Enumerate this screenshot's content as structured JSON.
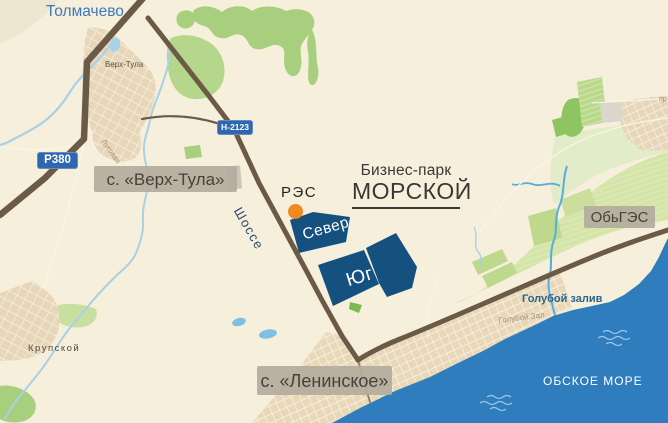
{
  "map": {
    "cities": {
      "tolmachevo": "Толмачево",
      "verh_tula_small": "Верх-Тула",
      "krupskoy": "Крупской"
    },
    "area_labels": {
      "verh_tula_village": "с. «Верх-Тула»",
      "leninskoe_village": "с. «Ленинское»",
      "obges": "ОбьГЭС"
    },
    "roads": {
      "r380_badge": "Р380",
      "n2123_badge": "Н-2123",
      "shosse": "Шоссе",
      "lugovaya_street": "Луговая",
      "prospekt_partial": "пр",
      "goluboy_zaliv_street": "Голубой Зал"
    },
    "business_park": {
      "name_line1": "Бизнес-парк",
      "name_line2": "МОРСКОЙ",
      "section_north": "Север",
      "section_south": "Юг",
      "res_station": "РЭС"
    },
    "water": {
      "sea": "ОБСКОЕ МОРЕ",
      "bay": "Голубой залив"
    },
    "colors": {
      "background": "#f6efdb",
      "sea_water": "#2f7dbd",
      "river": "#a8d0e6",
      "stream": "#58ade0",
      "park_sections_navy": "#14517f",
      "road_brown": "#6b5a46",
      "road_badge_blue": "#2e67b0",
      "res_marker_orange": "#f08a1e",
      "label_box_bg": "#b4ac9d",
      "forest_green": "#a7cf7e",
      "field_green": "#d5e5aa",
      "builtup_tan": "#e7d6b7",
      "city_label_blue": "#3f78bc",
      "water_label_blue": "#2a6390"
    }
  }
}
